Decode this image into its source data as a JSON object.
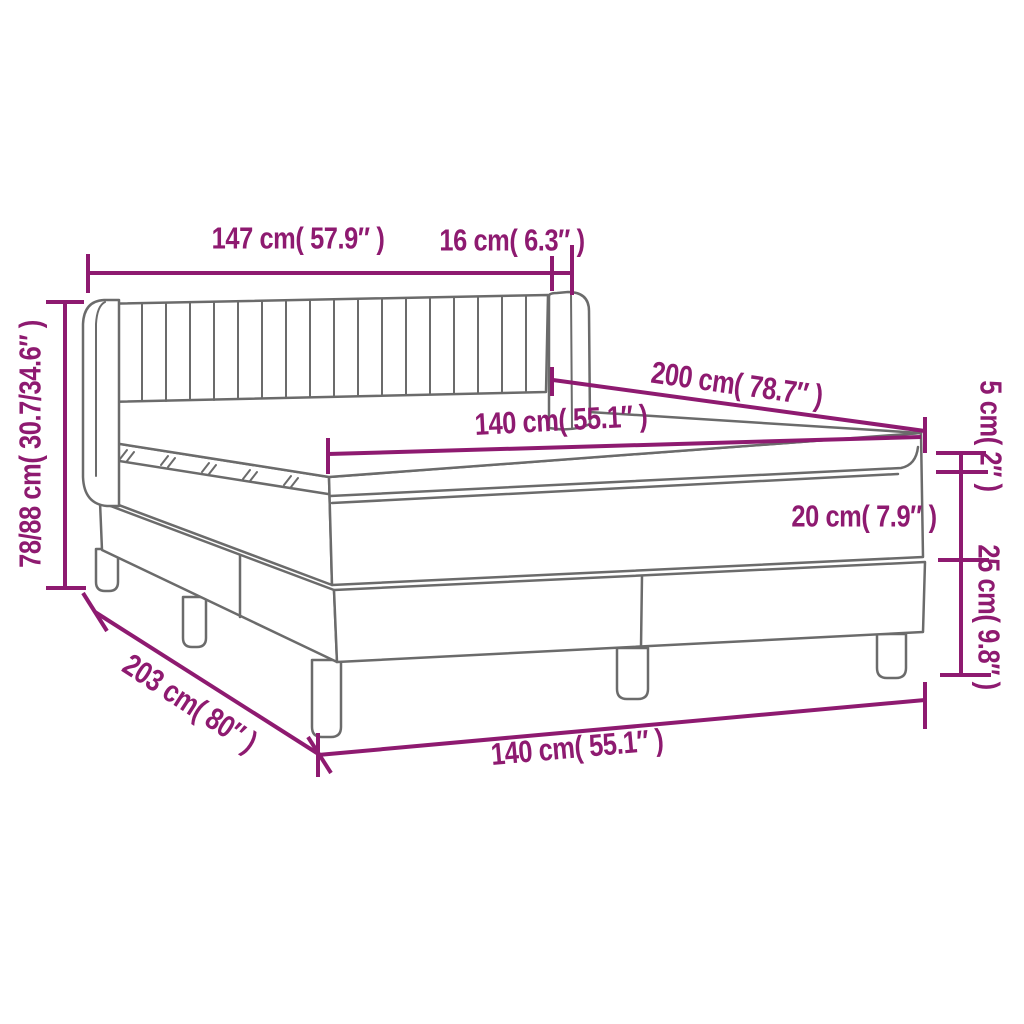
{
  "diagram": {
    "labels": {
      "width_head": "147 cm( 57.9″ )",
      "wing_depth": "16 cm( 6.3″ )",
      "height_total": "78/88 cm( 30.7/34.6″ )",
      "length_top": "200 cm( 78.7″ )",
      "width_mattress_top": "140 cm( 55.1″ )",
      "topper_height": "5 cm( 2″ )",
      "mattress_height": "20 cm( 7.9″ )",
      "base_height": "25 cm( 9.8″ )",
      "length_floor": "203 cm( 80″ )",
      "width_mattress_bottom": "140 cm( 55.1″ )"
    },
    "colors": {
      "dimension_color": "#8E1A70",
      "line_art_color": "#6B6B6B",
      "background": "#FFFFFF"
    }
  }
}
